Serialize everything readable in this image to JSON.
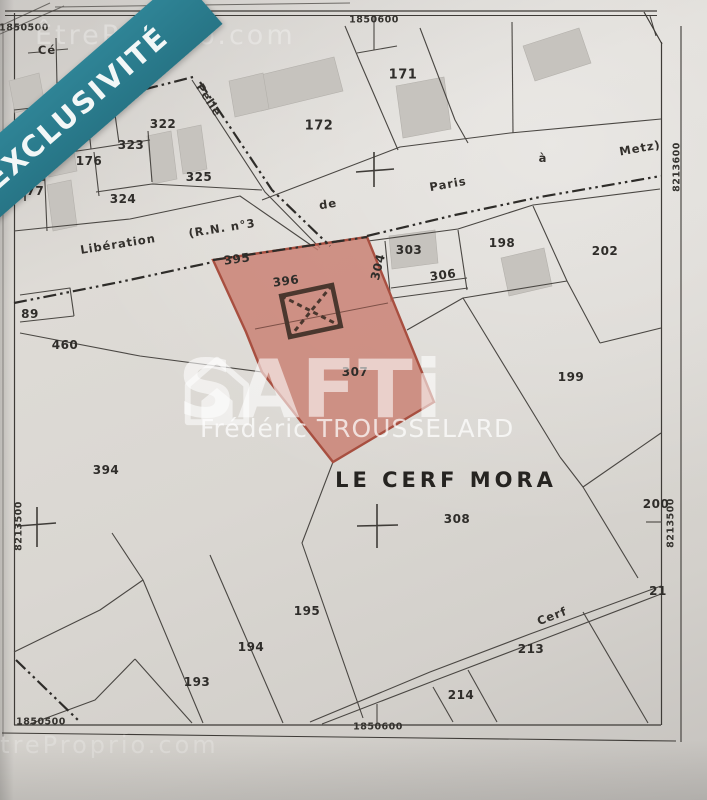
{
  "banner": {
    "label": "EXCLUSIVITÉ"
  },
  "watermarks": {
    "brand": "SAFTi",
    "agent": "Frédéric TROUSSELARD",
    "site": "ÊtreProprio.com"
  },
  "map": {
    "lieu_dit": "LE CERF MORA",
    "highlighted_parcel": "307",
    "colors": {
      "banner_teal": "#2b7b8c",
      "highlight_fill": "#c97f72",
      "highlight_stroke": "#a84f40",
      "paper": "#d9d6d1",
      "line": "#4a4743",
      "building_fill": "#c8c5c0"
    },
    "coordinate_labels": [
      {
        "t": "1850500",
        "x": 24,
        "y": 28,
        "r": 0
      },
      {
        "t": "1850600",
        "x": 374,
        "y": 20,
        "r": 0
      },
      {
        "t": "8213600",
        "x": 9,
        "y": 172,
        "r": -90
      },
      {
        "t": "8213500",
        "x": 19,
        "y": 526,
        "r": -90
      },
      {
        "t": "8213600",
        "x": 677,
        "y": 167,
        "r": -90
      },
      {
        "t": "8213500",
        "x": 671,
        "y": 523,
        "r": -90
      },
      {
        "t": "1850500",
        "x": 41,
        "y": 722,
        "r": 0
      },
      {
        "t": "1850600",
        "x": 378,
        "y": 727,
        "r": 0
      }
    ],
    "parcel_labels": [
      {
        "t": "177",
        "x": 31,
        "y": 191,
        "r": 0
      },
      {
        "t": "176",
        "x": 89,
        "y": 161,
        "r": 0
      },
      {
        "t": "322",
        "x": 163,
        "y": 124,
        "r": 0
      },
      {
        "t": "323",
        "x": 131,
        "y": 145,
        "r": 0
      },
      {
        "t": "324",
        "x": 123,
        "y": 199,
        "r": 0
      },
      {
        "t": "325",
        "x": 199,
        "y": 177,
        "r": 0
      },
      {
        "t": "172",
        "x": 319,
        "y": 126,
        "r": 0,
        "s": 13
      },
      {
        "t": "171",
        "x": 403,
        "y": 75,
        "r": 0,
        "s": 13
      },
      {
        "t": "395",
        "x": 237,
        "y": 259,
        "r": -8
      },
      {
        "t": "396",
        "x": 286,
        "y": 281,
        "r": -8
      },
      {
        "t": "304",
        "x": 378,
        "y": 267,
        "r": -76
      },
      {
        "t": "303",
        "x": 409,
        "y": 250,
        "r": 0
      },
      {
        "t": "306",
        "x": 443,
        "y": 275,
        "r": -8
      },
      {
        "t": "198",
        "x": 502,
        "y": 243,
        "r": 0
      },
      {
        "t": "202",
        "x": 605,
        "y": 251,
        "r": 0
      },
      {
        "t": "89",
        "x": 30,
        "y": 314,
        "r": 0
      },
      {
        "t": "460",
        "x": 65,
        "y": 345,
        "r": 0
      },
      {
        "t": "307",
        "x": 355,
        "y": 372,
        "r": 0
      },
      {
        "t": "199",
        "x": 571,
        "y": 377,
        "r": 0
      },
      {
        "t": "394",
        "x": 106,
        "y": 470,
        "r": 0
      },
      {
        "t": "308",
        "x": 457,
        "y": 519,
        "r": 0
      },
      {
        "t": "200",
        "x": 656,
        "y": 504,
        "r": 0
      },
      {
        "t": "195",
        "x": 307,
        "y": 611,
        "r": 0
      },
      {
        "t": "194",
        "x": 251,
        "y": 647,
        "r": 0
      },
      {
        "t": "193",
        "x": 197,
        "y": 682,
        "r": 0
      },
      {
        "t": "213",
        "x": 531,
        "y": 649,
        "r": 0
      },
      {
        "t": "214",
        "x": 461,
        "y": 695,
        "r": 0
      },
      {
        "t": "21",
        "x": 658,
        "y": 591,
        "r": 0
      }
    ],
    "street_labels": [
      {
        "t": "Cé",
        "x": 47,
        "y": 50,
        "r": 0
      },
      {
        "t": "Pelle",
        "x": 209,
        "y": 100,
        "r": 57
      },
      {
        "t": "Libération",
        "x": 118,
        "y": 244,
        "r": -9
      },
      {
        "t": "(R.N. n°3",
        "x": 222,
        "y": 228,
        "r": -9
      },
      {
        "t": "de",
        "x": 328,
        "y": 204,
        "r": -9
      },
      {
        "t": "Paris",
        "x": 448,
        "y": 184,
        "r": -10
      },
      {
        "t": "à",
        "x": 543,
        "y": 158,
        "r": 0
      },
      {
        "t": "Metz)",
        "x": 640,
        "y": 148,
        "r": -10
      },
      {
        "t": "Cerf",
        "x": 552,
        "y": 616,
        "r": -21
      }
    ]
  }
}
